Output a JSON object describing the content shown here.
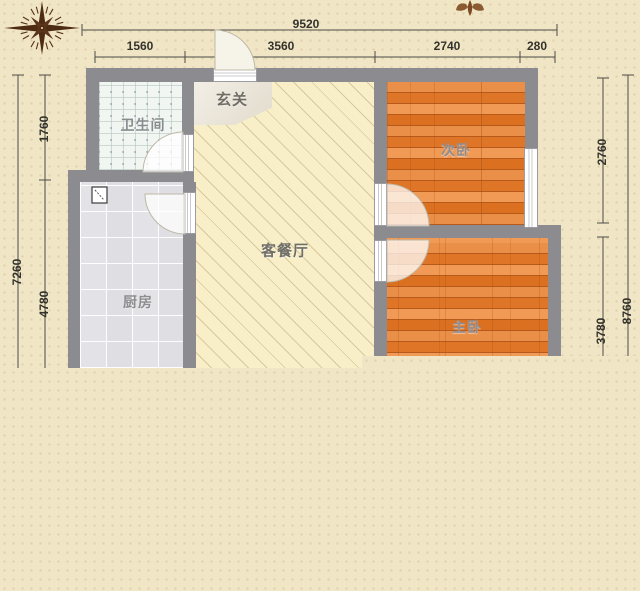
{
  "plan": {
    "type": "apartment-floor-plan",
    "rooms": {
      "entry": {
        "label": "玄关"
      },
      "bathroom": {
        "label": "卫生间"
      },
      "kitchen": {
        "label": "厨房"
      },
      "living": {
        "label": "客餐厅"
      },
      "bedroom2": {
        "label": "次卧"
      },
      "master": {
        "label": "主卧"
      }
    },
    "dims": {
      "total_width": "9520",
      "top": [
        "1560",
        "3560",
        "2740",
        "280"
      ],
      "left_total": "7260",
      "left": [
        "1760",
        "4780"
      ],
      "right": [
        "2760",
        "3780"
      ],
      "right_total": "8760"
    },
    "icons": {
      "compass": "compass-rose",
      "ornament": "fleuron-partial",
      "kitchen_fixture": "water-heater"
    },
    "colors": {
      "background": "#f0e5c5",
      "wall": "#8b8b90",
      "wood_floor": "#e0762a",
      "hatch_floor": "#f8efc8",
      "kitchen_tile": "#e8e8eb",
      "bath_tile": "#f2f6f2",
      "dim_line": "#4d4c46"
    }
  }
}
